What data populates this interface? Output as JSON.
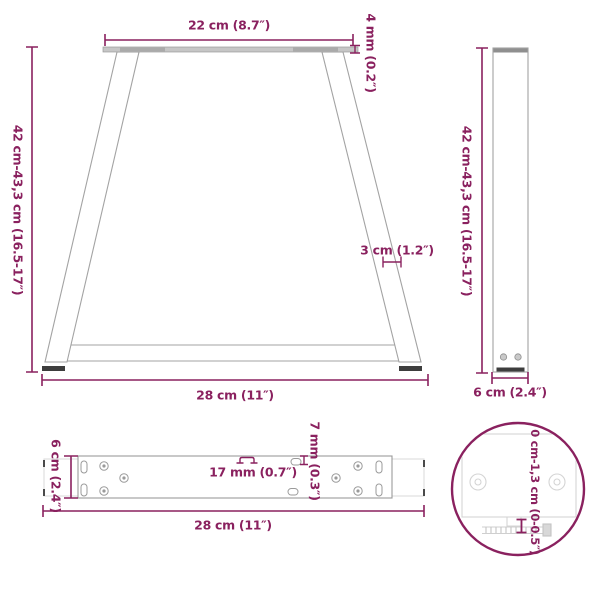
{
  "title": "Table leg dimension diagram",
  "colors": {
    "accent": "#8A215F",
    "drawing_gray": "#A3A3A3",
    "light_gray": "#D2D2D2",
    "plate_fill": "#C6C6C6",
    "foot_dark": "#3D3D3D"
  },
  "front_view": {
    "top_width": "22 cm (8.7″)",
    "plate_thickness": "4 mm (0.2″)",
    "height_range": "42 cm-43,3 cm (16.5-17″)",
    "leg_profile_width": "3 cm (1.2″)",
    "base_width": "28 cm (11″)"
  },
  "side_view": {
    "height_range": "42 cm-43,3 cm (16.5-17″)",
    "leg_depth": "6 cm (2.4″)"
  },
  "plate_view": {
    "plate_depth": "6 cm (2.4″)",
    "hole_width": "17 mm (0.7″)",
    "slot_width": "7 mm (0.3″)",
    "base_length": "28 cm (11″)"
  },
  "detail_view": {
    "foot_adjust_range": "0 cm-1,3 cm (0-0.5″)"
  }
}
